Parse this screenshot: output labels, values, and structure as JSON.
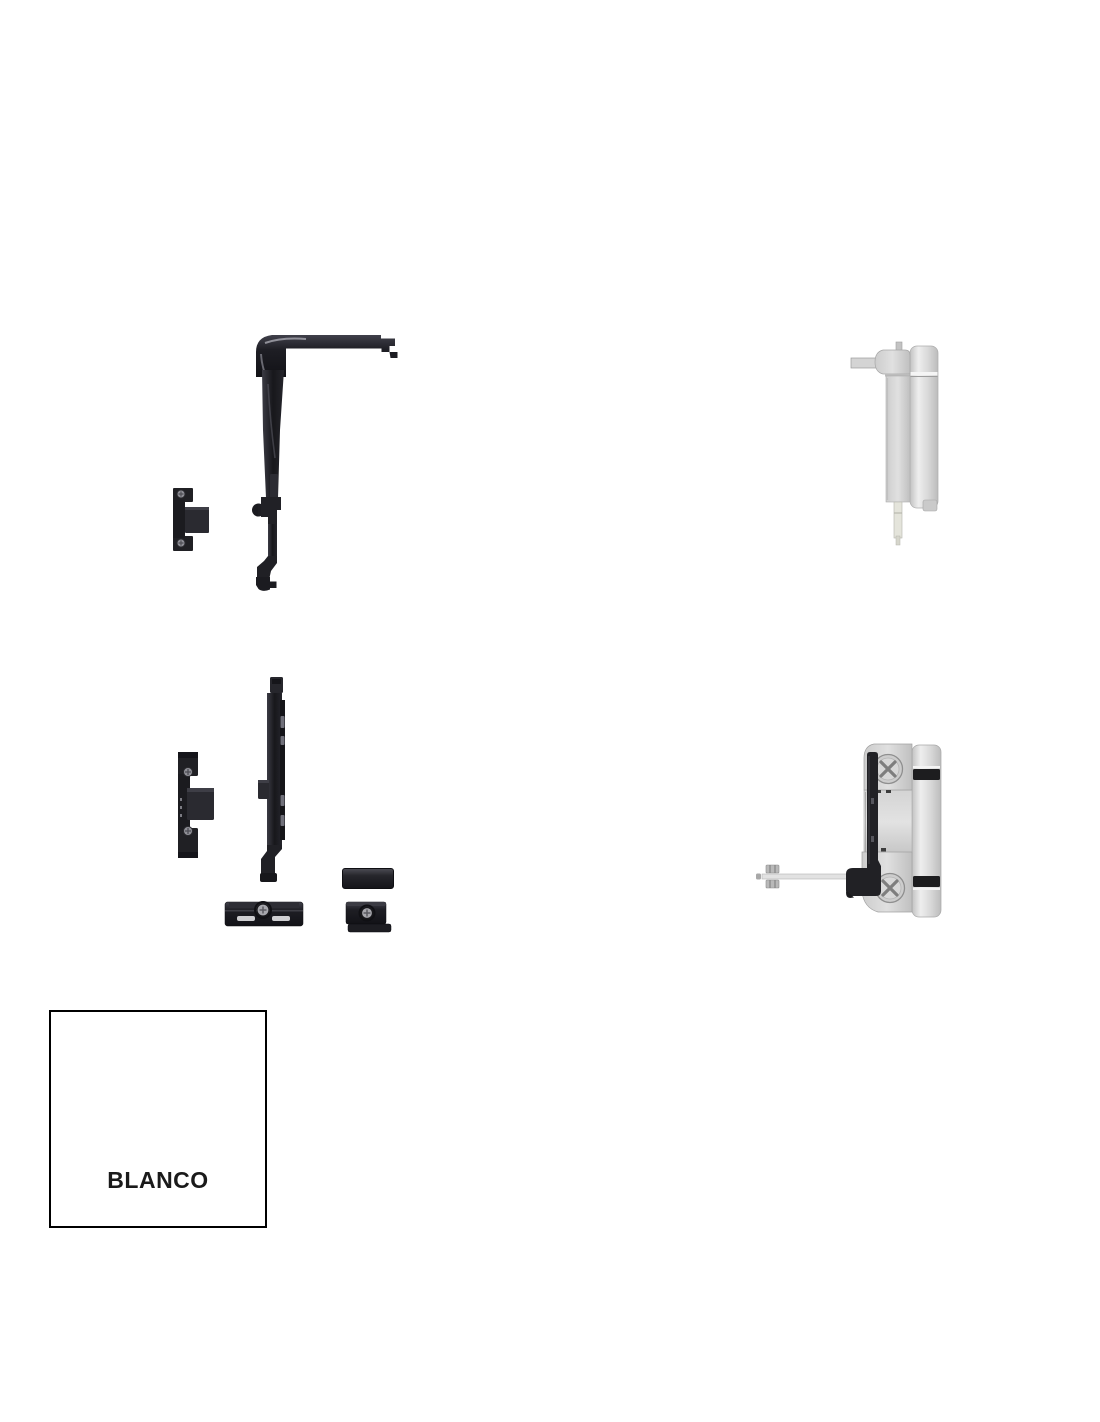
{
  "page": {
    "background_color": "#ffffff"
  },
  "colors": {
    "part_black": "#1b1b20",
    "part_black_highlight": "#4a4a52",
    "part_silver_light": "#eeeeee",
    "part_silver": "#d8d8d8",
    "part_silver_dark": "#bcbcbc",
    "rubber_band_black": "#1d1d1f",
    "screw_gray": "#cdcdcd",
    "swatch_background": "#ffffff",
    "swatch_border": "#000000",
    "swatch_text": "#1a1a1a"
  },
  "parts": [
    {
      "id": "corner-drive"
    },
    {
      "id": "keeper-small"
    },
    {
      "id": "hinge-top"
    },
    {
      "id": "keeper-large"
    },
    {
      "id": "locking-rail"
    },
    {
      "id": "spacer-bar"
    },
    {
      "id": "slotted-plate"
    },
    {
      "id": "screw-block"
    },
    {
      "id": "hinge-bottom"
    }
  ],
  "swatch": {
    "label": "BLANCO"
  }
}
